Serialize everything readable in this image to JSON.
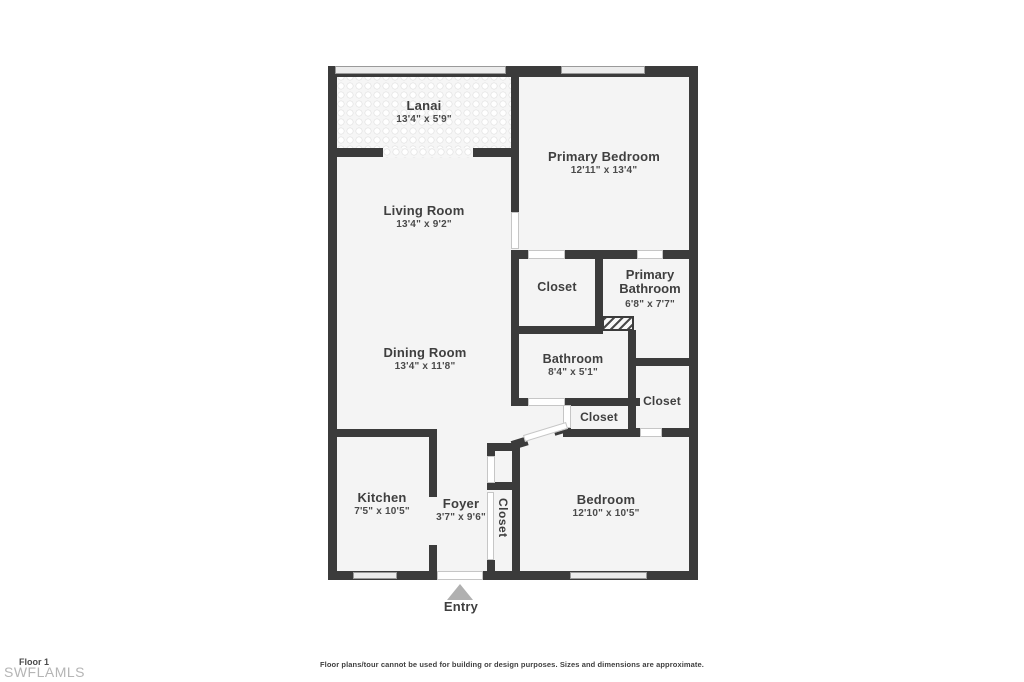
{
  "plan": {
    "rooms": {
      "lanai": {
        "name": "Lanai",
        "dims": "13'4\" x 5'9\""
      },
      "living_room": {
        "name": "Living Room",
        "dims": "13'4\" x 9'2\""
      },
      "primary_bedroom": {
        "name": "Primary Bedroom",
        "dims": "12'11\" x 13'4\""
      },
      "closet_top": {
        "name": "Closet"
      },
      "primary_bathroom": {
        "name": "Primary Bathroom",
        "dims": "6'8\" x 7'7\""
      },
      "dining_room": {
        "name": "Dining Room",
        "dims": "13'4\" x 11'8\""
      },
      "bathroom": {
        "name": "Bathroom",
        "dims": "8'4\" x 5'1\""
      },
      "closet_right": {
        "name": "Closet"
      },
      "closet_hall": {
        "name": "Closet"
      },
      "kitchen": {
        "name": "Kitchen",
        "dims": "7'5\" x 10'5\""
      },
      "foyer": {
        "name": "Foyer",
        "dims": "3'7\" x 9'6\""
      },
      "closet_foyer": {
        "name": "Closet"
      },
      "bedroom": {
        "name": "Bedroom",
        "dims": "12'10\" x 10'5\""
      }
    },
    "entry_label": "Entry",
    "footer": {
      "floor_label": "Floor 1",
      "watermark": "SWFLAMLS",
      "disclaimer": "Floor plans/tour cannot be used for building or design purposes. Sizes and dimensions are approximate."
    },
    "colors": {
      "wall": "#3b3b3b",
      "room_fill": "#f4f4f4",
      "text": "#3f3f3f",
      "watermark": "#b5b5b5",
      "entry_arrow": "#b0b0b0"
    }
  }
}
